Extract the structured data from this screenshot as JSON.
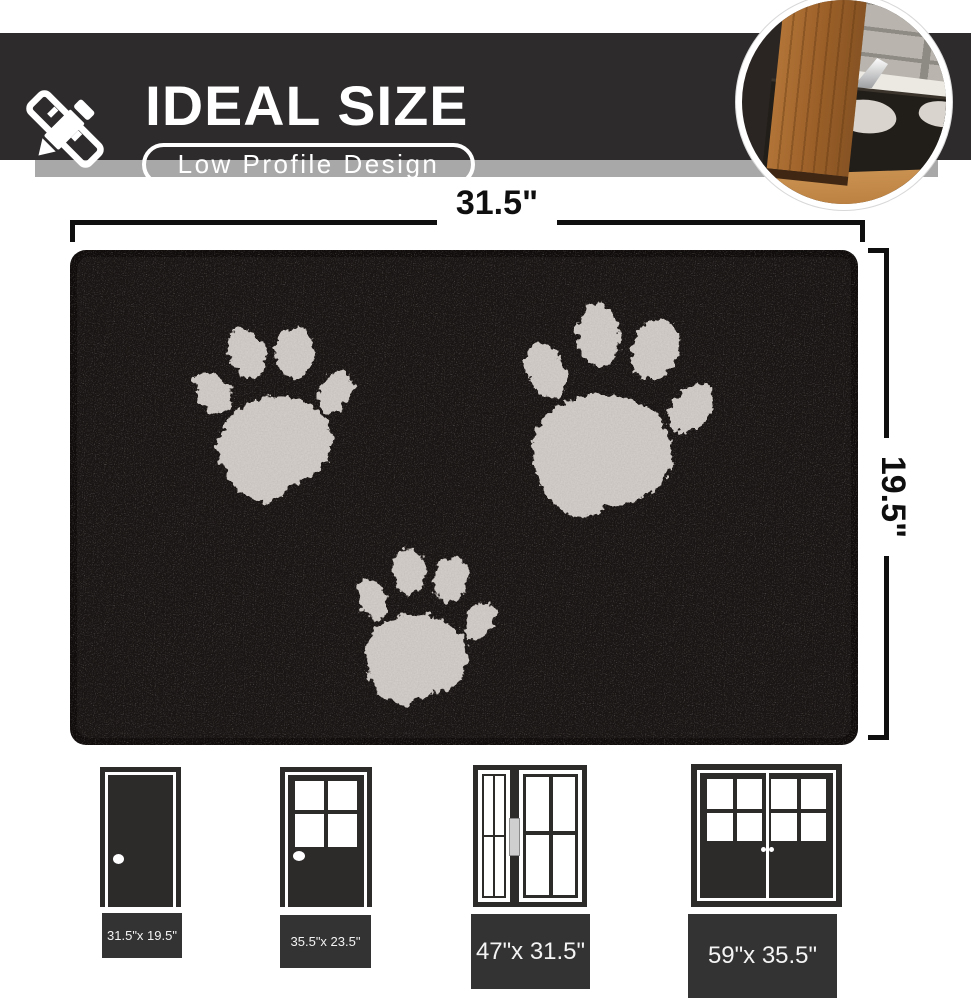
{
  "header": {
    "title": "IDEAL SIZE",
    "badge": "Low Profile Design",
    "icon": "pencil-ruler-icon",
    "bar_color": "#2d2b2c",
    "shadow_color": "#a8a8a8"
  },
  "inset_photo": {
    "subject": "door swinging clear over low-profile black mat",
    "shape": "circle"
  },
  "mat_diagram": {
    "width_label": "31.5\"",
    "height_label": "19.5\"",
    "mat_color": "#151110",
    "paw_color": "#d9d3cf",
    "paw_count": 3
  },
  "size_options": [
    {
      "door_type": "single solid door",
      "label": "31.5\"x 19.5\""
    },
    {
      "door_type": "half glass door",
      "label": "35.5\"x 23.5\""
    },
    {
      "door_type": "sliding glass door",
      "label": "47\"x 31.5\""
    },
    {
      "door_type": "double french door",
      "label": "59\"x 35.5\""
    }
  ]
}
